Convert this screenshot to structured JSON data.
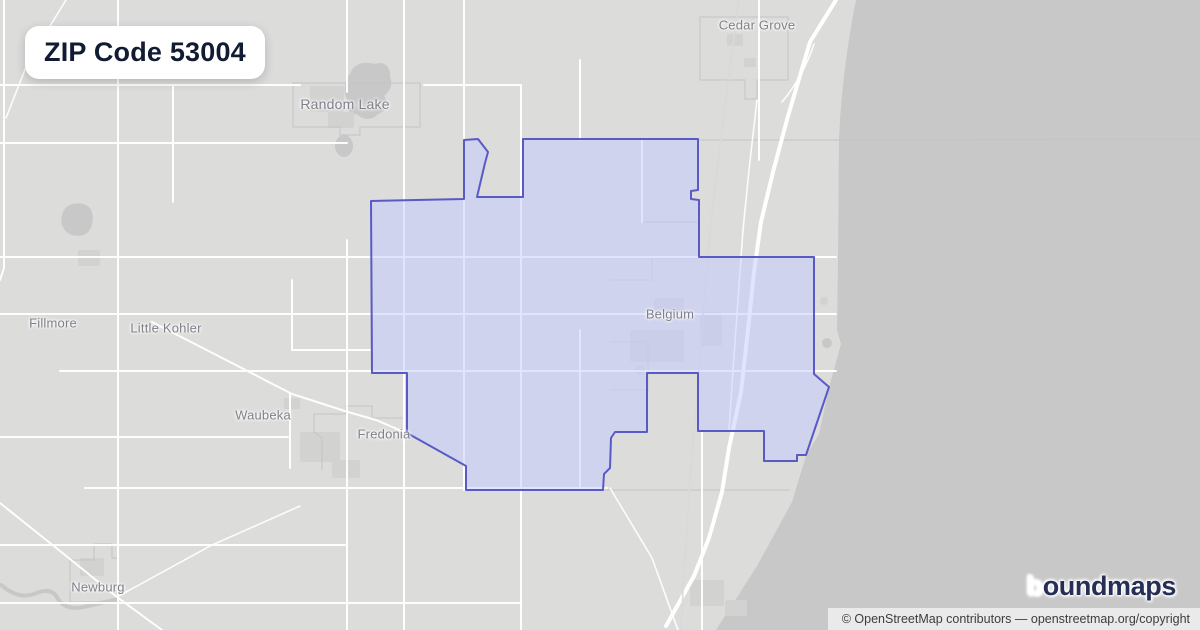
{
  "badge": {
    "title": "ZIP Code 53004"
  },
  "map": {
    "places": [
      {
        "name": "Cedar Grove"
      },
      {
        "name": "Random Lake"
      },
      {
        "name": "Fillmore"
      },
      {
        "name": "Little Kohler"
      },
      {
        "name": "Belgium"
      },
      {
        "name": "Waubeka"
      },
      {
        "name": "Fredonia"
      },
      {
        "name": "Newburg"
      }
    ]
  },
  "branding": {
    "logo_b": "b",
    "logo_rest": "oundmaps"
  },
  "attribution": {
    "text": "© OpenStreetMap contributors — openstreetmap.org/copyright"
  },
  "colors": {
    "land": "#dcdcdb",
    "water": "#c8c8c9",
    "road": "#ffffff",
    "boundary_gray": "#c4c4c7",
    "urban": "#d2d2d1",
    "zip_fill": "rgba(194,202,255,0.5)",
    "zip_stroke": "#5a5ac6",
    "label_gray": "#80808a",
    "badge_text": "#111c33",
    "logo_navy": "#262e55",
    "logo_purple": "#905cf0",
    "logo_teal": "#2bbfae",
    "attribution_bg": "rgba(255,255,255,0.62)",
    "attribution_text": "#3d3d3d"
  }
}
